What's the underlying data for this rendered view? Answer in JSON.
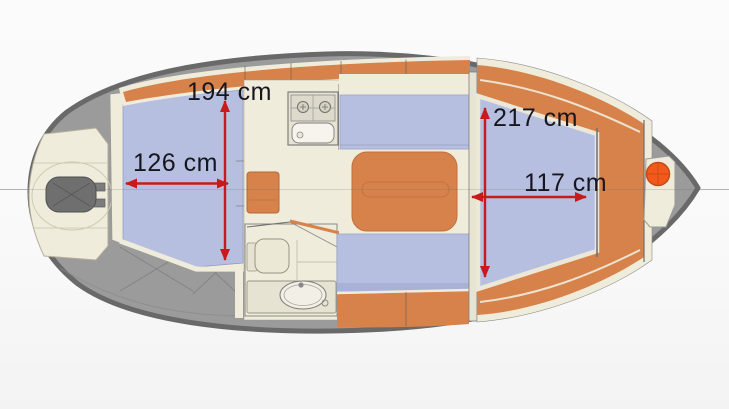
{
  "diagram": {
    "kind": "boat-floorplan-top-view",
    "unit": "cm"
  },
  "dimensions": {
    "aft_length": {
      "label": "194 cm",
      "value": 194,
      "orientation": "vertical"
    },
    "aft_width": {
      "label": "126 cm",
      "value": 126,
      "orientation": "horizontal"
    },
    "bow_length": {
      "label": "217 cm",
      "value": 217,
      "orientation": "vertical"
    },
    "bow_width": {
      "label": "117 cm",
      "value": 117,
      "orientation": "horizontal"
    }
  },
  "colors": {
    "hull_outline": "#696969",
    "deck_gray": "#9b9b9b",
    "cabin_blue": "#b7bfe0",
    "wood_orange": "#d6824a",
    "floor_cream": "#efecdb",
    "arrow_red": "#c81a1a",
    "winch_orange": "#f2591b",
    "label_text": "#16161e"
  }
}
